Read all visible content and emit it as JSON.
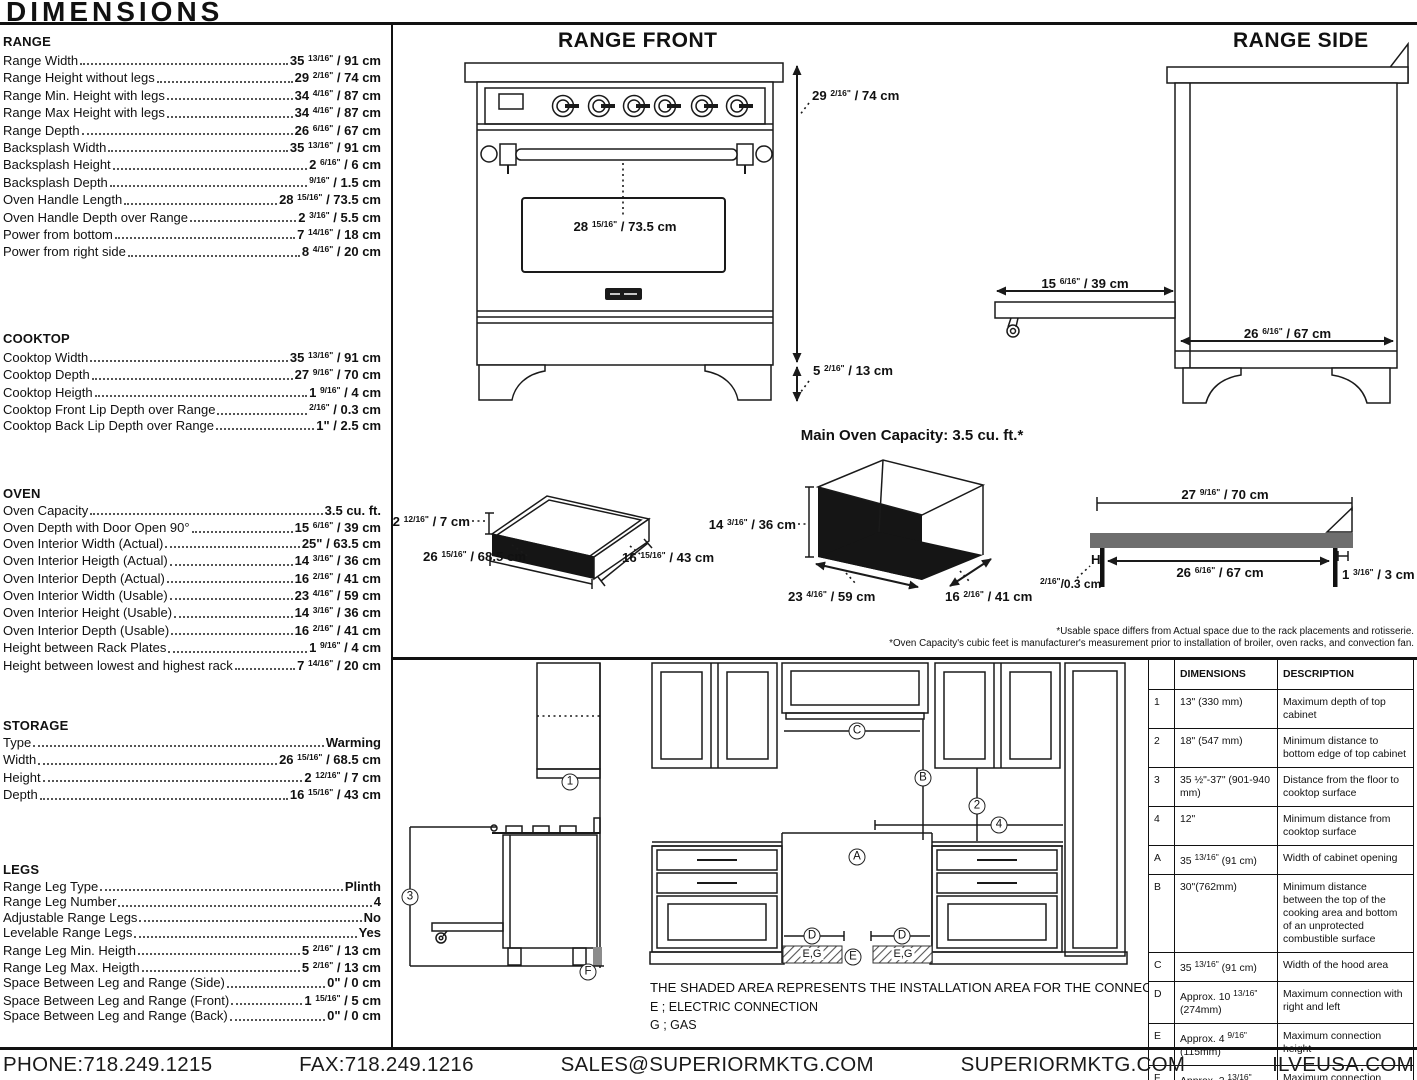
{
  "title": "DIMENSIONS",
  "sections": [
    {
      "heading": "RANGE",
      "rows": [
        {
          "label": "Range Width",
          "value": "35 13/16\" / 91 cm"
        },
        {
          "label": "Range Height without legs",
          "value": "29 2/16\" / 74 cm"
        },
        {
          "label": "Range Min. Height with legs",
          "value": "34 4/16\" / 87 cm"
        },
        {
          "label": "Range Max Height with legs",
          "value": "34 4/16\" / 87 cm"
        },
        {
          "label": "Range Depth",
          "value": "26 6/16\" / 67 cm"
        },
        {
          "label": "Backsplash Width",
          "value": "35 13/16\" / 91 cm"
        },
        {
          "label": "Backsplash Height",
          "value": "2 6/16\" / 6 cm"
        },
        {
          "label": "Backsplash Depth",
          "value": "9/16\" / 1.5 cm"
        },
        {
          "label": "Oven Handle Length",
          "value": "28 15/16\" / 73.5 cm"
        },
        {
          "label": "Oven Handle Depth over Range",
          "value": "2 3/16\" / 5.5 cm"
        },
        {
          "label": "Power from bottom",
          "value": "7 14/16\" / 18 cm"
        },
        {
          "label": "Power from right side",
          "value": "8 4/16\" / 20 cm"
        }
      ]
    },
    {
      "heading": "COOKTOP",
      "rows": [
        {
          "label": "Cooktop Width",
          "value": "35 13/16\" / 91 cm"
        },
        {
          "label": "Cooktop Depth",
          "value": "27 9/16\" / 70 cm"
        },
        {
          "label": "Cooktop Heigth",
          "value": "1 9/16\" / 4 cm"
        },
        {
          "label": "Cooktop Front Lip Depth over Range",
          "value": "2/16\" / 0.3 cm"
        },
        {
          "label": "Cooktop Back Lip Depth over Range",
          "value": "1\" / 2.5 cm"
        }
      ]
    },
    {
      "heading": "OVEN",
      "rows": [
        {
          "label": "Oven Capacity",
          "value": "3.5 cu. ft."
        },
        {
          "label": "Oven Depth with Door Open 90°",
          "value": "15 6/16\" / 39 cm"
        },
        {
          "label": "Oven Interior Width (Actual)",
          "value": "25\" / 63.5 cm"
        },
        {
          "label": "Oven Interior Heigth (Actual)",
          "value": "14 3/16\" / 36 cm"
        },
        {
          "label": "Oven Interior Depth (Actual)",
          "value": "16 2/16\" / 41 cm"
        },
        {
          "label": "Oven Interior Width (Usable)",
          "value": "23 4/16\" / 59 cm"
        },
        {
          "label": "Oven Interior Height (Usable)",
          "value": "14 3/16\" / 36 cm"
        },
        {
          "label": "Oven Interior Depth (Usable)",
          "value": "16 2/16\" / 41 cm"
        },
        {
          "label": "Height between Rack Plates",
          "value": "1 9/16\" / 4 cm"
        },
        {
          "label": "Height between lowest and highest rack",
          "value": "7 14/16\" / 20 cm"
        }
      ]
    },
    {
      "heading": "STORAGE",
      "rows": [
        {
          "label": "Type",
          "value": "Warming"
        },
        {
          "label": "Width",
          "value": "26 15/16\" / 68.5 cm"
        },
        {
          "label": "Height",
          "value": "2 12/16\" / 7 cm"
        },
        {
          "label": "Depth",
          "value": "16 15/16\" / 43 cm"
        }
      ]
    },
    {
      "heading": "LEGS",
      "rows": [
        {
          "label": "Range Leg Type",
          "value": "Plinth"
        },
        {
          "label": "Range Leg Number",
          "value": "4"
        },
        {
          "label": "Adjustable Range Legs",
          "value": "No"
        },
        {
          "label": "Levelable Range Legs",
          "value": "Yes"
        },
        {
          "label": "Range Leg Min. Heigth",
          "value": "5 2/16\" / 13 cm"
        },
        {
          "label": "Range Leg Max. Heigth",
          "value": "5 2/16\" / 13 cm"
        },
        {
          "label": "Space Between Leg and Range (Side)",
          "value": "0\" / 0 cm"
        },
        {
          "label": "Space Between Leg and Range (Front)",
          "value": "1 15/16\" / 5 cm"
        },
        {
          "label": "Space Between Leg and Range (Back)",
          "value": "0\" / 0 cm"
        }
      ]
    }
  ],
  "range_front": {
    "title": "RANGE FRONT",
    "height": "29 2/16\" / 74 cm",
    "leg": "5 2/16\" / 13 cm",
    "handle": "28 15/16\" / 73.5 cm"
  },
  "range_side": {
    "title": "RANGE SIDE",
    "door": "15 6/16\" / 39 cm",
    "depth": "26 6/16\" / 67 cm"
  },
  "capacity": {
    "title": "Main Oven Capacity: 3.5 cu. ft.*",
    "drawer": {
      "height": "2 12/16\" / 7 cm",
      "width": "26 15/16\" / 68.5 cm",
      "depth": "16 15/16\" / 43 cm"
    },
    "oven": {
      "height": "14 3/16\" / 36 cm",
      "width": "23 4/16\" / 59 cm",
      "depth": "16 2/16\" / 41 cm"
    },
    "rack": {
      "top": "27 9/16\" / 70 cm",
      "inner": "26 6/16\" / 67 cm",
      "right": "1 3/16\" / 3 cm",
      "left": "2/16\"/0.3 cm",
      "h": "H"
    },
    "footnote1": "*Usable space differs from Actual space due to the rack placements and rotisserie.",
    "footnote2": "*Oven Capacity's cubic feet is manufacturer's measurement prior to installation of broiler, oven racks, and convection fan."
  },
  "installation": {
    "callouts": {
      "n1": "1",
      "n2": "2",
      "n3": "3",
      "n4": "4",
      "A": "A",
      "B": "B",
      "C": "C",
      "D": "D",
      "E": "E",
      "F": "F"
    },
    "shaded_label": "E,G",
    "note": "THE SHADED AREA REPRESENTS THE INSTALLATION AREA FOR THE CONNECTIONS;",
    "legend": [
      "E ; ELECTRIC CONNECTION",
      "G ; GAS"
    ]
  },
  "table": {
    "headers": [
      "",
      "DIMENSIONS",
      "DESCRIPTION"
    ],
    "rows": [
      [
        "1",
        "13\" (330 mm)",
        "Maximum depth of top cabinet"
      ],
      [
        "2",
        "18\" (547 mm)",
        "Minimum distance to bottom edge of top cabinet"
      ],
      [
        "3",
        "35 ½\"-37\" (901-940 mm)",
        "Distance from the floor to cooktop surface"
      ],
      [
        "4",
        "12\"",
        "Minimum distance from cooktop surface"
      ],
      [
        "A",
        "35 13/16\" (91 cm)",
        "Width of cabinet opening"
      ],
      [
        "B",
        "30\"(762mm)",
        "Minimum distance between the top of the cooking area and bottom of an unprotected combustible surface"
      ],
      [
        "C",
        "35 13/16\" (91 cm)",
        "Width of the hood area"
      ],
      [
        "D",
        "Approx. 10 13/16\" (274mm)",
        "Maximum connection with right and left"
      ],
      [
        "E",
        "Approx. 4 9/16\" (115mm)",
        "Maximum connection height"
      ],
      [
        "F",
        "Approx. 2 13/16\" (72mm)",
        "Maximum connection depth"
      ]
    ]
  },
  "footer": {
    "items": [
      "PHONE:718.249.1215",
      "FAX:718.249.1216",
      "SALES@SUPERIORMKTG.COM",
      "SUPERIORMKTG.COM",
      "ILVEUSA.COM"
    ]
  }
}
